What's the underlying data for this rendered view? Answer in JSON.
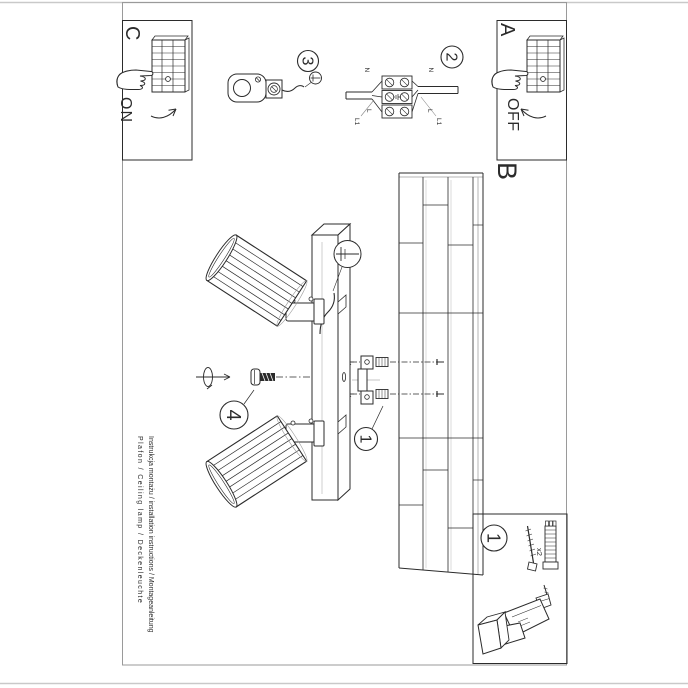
{
  "document": {
    "section_labels": {
      "a": "A",
      "b": "B",
      "c": "C"
    },
    "switch": {
      "on": "ON",
      "off": "OFF"
    },
    "steps": {
      "step1": "1",
      "step2": "2",
      "step3": "3",
      "step4": "4"
    },
    "wiring": {
      "n_left": "N",
      "n_right": "N",
      "l_left": "L",
      "l_right": "L",
      "l1_left": "L1",
      "l1_right": "L1"
    },
    "hardware": {
      "qty": "x2"
    },
    "footer": {
      "line1": "Instrukcja montażu / installation instructions / Montageanleitung",
      "line2": "Plafon / Ceiling lamp / Deckenleuchte"
    },
    "icons": {
      "screwdriver": "flat-screwdriver",
      "hand": "pressing-hand",
      "drill": "power-drill",
      "rotation": "turn-arrow"
    },
    "colors": {
      "ink": "#2b2b2b",
      "paper": "#ffffff",
      "border": "#9a9a9a"
    }
  }
}
